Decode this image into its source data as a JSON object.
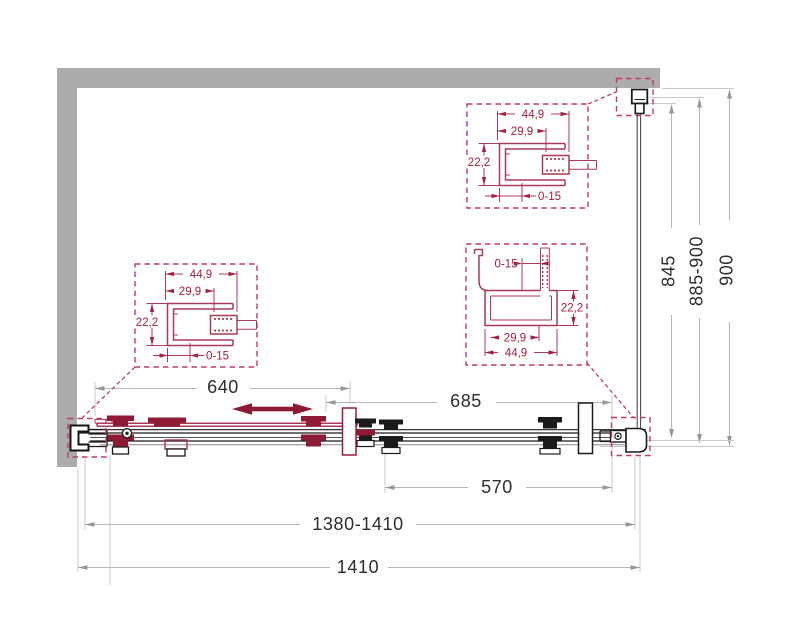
{
  "drawing": {
    "type": "shower-enclosure-plan-technical-drawing",
    "dimensions": {
      "door_travel": "640",
      "door_panel": "685",
      "fixed_panel": "570",
      "width_adjustable": "1380-1410",
      "width_overall": "1410",
      "side_glass_height": "845",
      "depth_adjustable": "885-900",
      "depth_overall": "900"
    },
    "profile_details": {
      "left": {
        "width": "44,9",
        "inner_width": "29,9",
        "depth": "22,2",
        "adjustment": "0-15"
      },
      "top": {
        "width": "44,9",
        "inner_width": "29,9",
        "depth": "22,2",
        "adjustment": "0-15"
      },
      "right": {
        "adjustment": "0-15",
        "depth": "22,2",
        "inner_width": "29,9",
        "width": "44,9"
      }
    },
    "colors": {
      "wall_gray": "#acacac",
      "detail_red": "#a32040",
      "arrow_red": "#8d1a33",
      "dim_line_gray": "#b6b6b6",
      "dim_text": "#2d2d2d",
      "drawing_black": "#1b1b1b"
    }
  }
}
